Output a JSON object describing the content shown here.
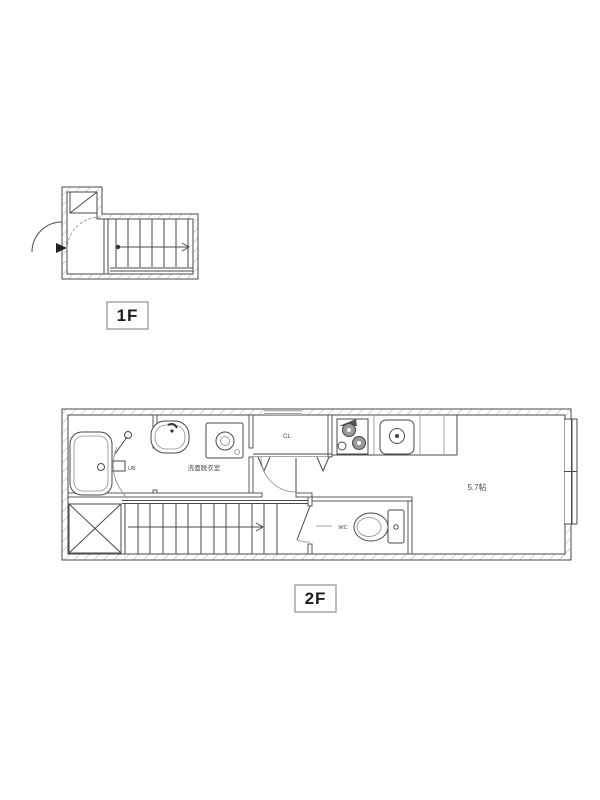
{
  "document": {
    "kind": "apartment floor plan",
    "background": "#ffffff"
  },
  "colors": {
    "line": "#4a4a4a",
    "hatch": "#9a9a9a",
    "label_box_border": "#999999",
    "floor_label_text": "#1c1c1c",
    "room_label_text": "#4a4a4a"
  },
  "floors": {
    "f1": {
      "label": "1F"
    },
    "f2": {
      "label": "2F"
    }
  },
  "rooms": {
    "bath": "UB",
    "washroom": "洗面脱衣室",
    "closet": "CL",
    "toilet": "WC",
    "living": "5.7帖"
  }
}
